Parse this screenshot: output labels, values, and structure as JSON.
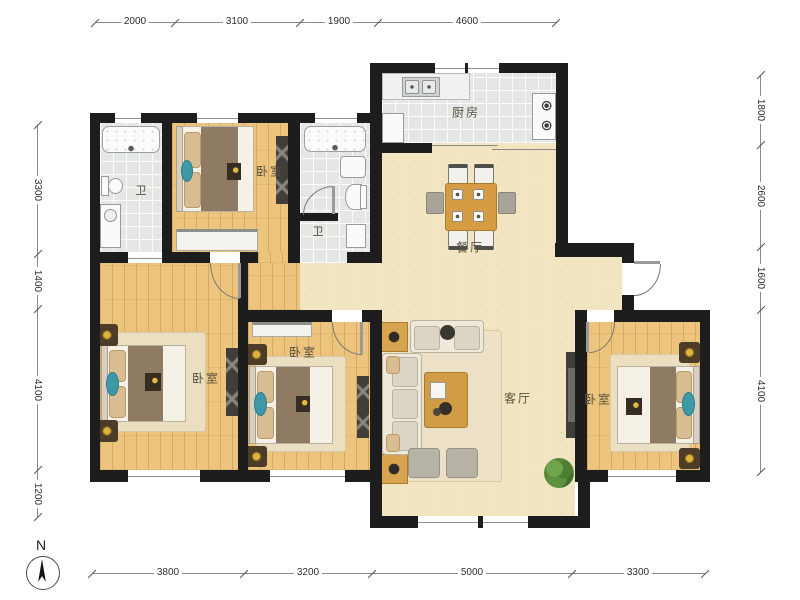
{
  "title": "apartment-floor-plan",
  "compass": {
    "north_label": "N"
  },
  "rooms": {
    "kitchen": "厨房",
    "dining": "餐厅",
    "living": "客厅",
    "bedroom_top": "卧室",
    "bedroom_left": "卧室",
    "bedroom_middle": "卧室",
    "bedroom_right": "卧室",
    "bath_main": "卫",
    "bath_second": "卫"
  },
  "dims": {
    "top": [
      "2000",
      "3100",
      "1900",
      "4600"
    ],
    "bottom": [
      "3800",
      "3200",
      "5000",
      "3300"
    ],
    "left": [
      "3300",
      "1400",
      "4100",
      "1200"
    ],
    "right": [
      "1800",
      "2600",
      "1600",
      "4100"
    ]
  },
  "colors": {
    "wall": "#1d1d1d",
    "wood_floor": "#ecc47e",
    "tile_floor": "#e4e7e4",
    "beige_floor": "#f3e5c1",
    "teal_accent": "#3f98a6",
    "table_wood": "#d59c44"
  }
}
